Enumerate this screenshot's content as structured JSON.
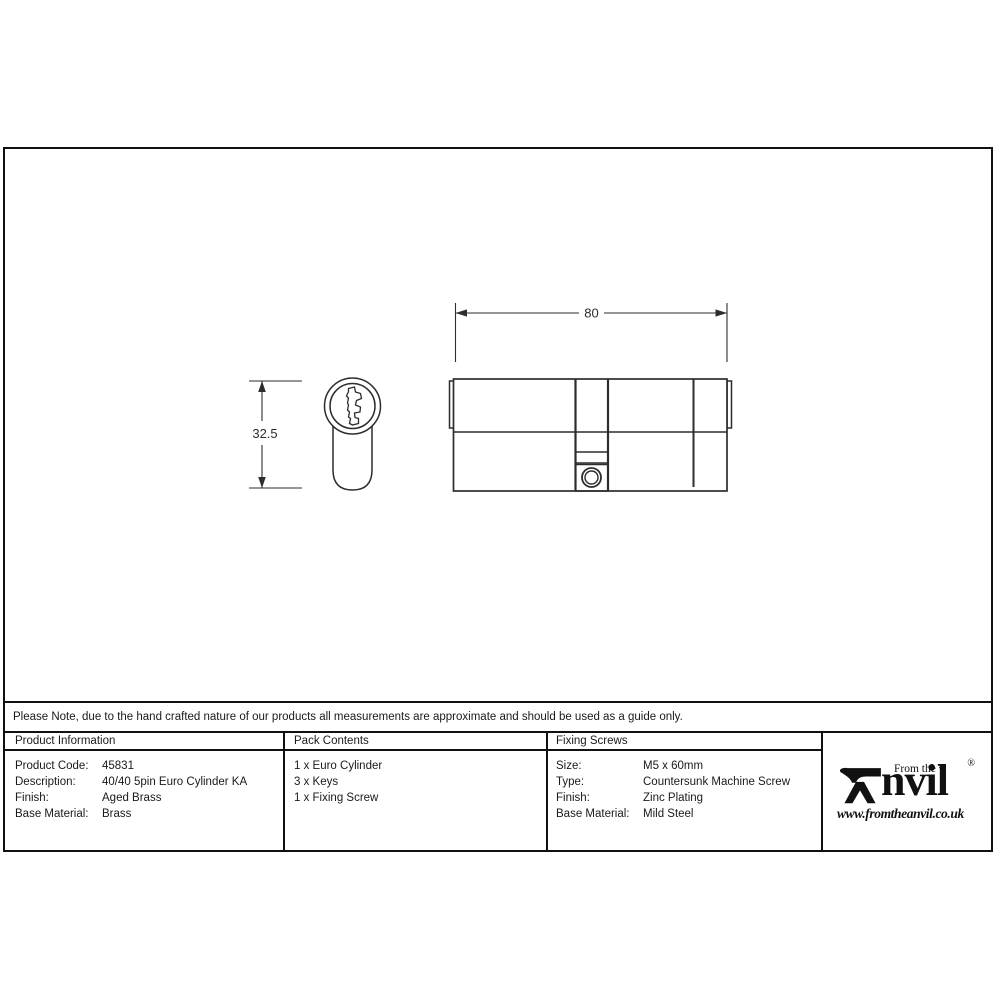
{
  "colors": {
    "background": "#ffffff",
    "border": "#111111",
    "drawing_line": "#2d2d2d",
    "text": "#1a1a1a"
  },
  "drawing": {
    "side_view_width_label": "80",
    "front_view_height_label": "32.5"
  },
  "note": {
    "text": "Please Note, due to the hand crafted nature of our products all measurements are approximate and should be used as a guide only."
  },
  "table": {
    "product_information": {
      "header": "Product Information",
      "rows": [
        {
          "label": "Product Code:",
          "value": "45831"
        },
        {
          "label": "Description:",
          "value": "40/40 5pin Euro Cylinder KA"
        },
        {
          "label": "Finish:",
          "value": "Aged Brass"
        },
        {
          "label": "Base Material:",
          "value": "Brass"
        }
      ]
    },
    "pack_contents": {
      "header": "Pack Contents",
      "items": [
        {
          "text": "1 x Euro Cylinder"
        },
        {
          "text": "3 x Keys"
        },
        {
          "text": "1 x Fixing Screw"
        }
      ]
    },
    "fixing_screws": {
      "header": "Fixing Screws",
      "rows": [
        {
          "label": "Size:",
          "value": "M5 x 60mm"
        },
        {
          "label": "Type:",
          "value": "Countersunk Machine Screw"
        },
        {
          "label": "Finish:",
          "value": "Zinc Plating"
        },
        {
          "label": "Base Material:",
          "value": "Mild Steel"
        }
      ]
    }
  },
  "logo": {
    "tagline": "From the",
    "diamond": "♦",
    "brand_rest": "nvil",
    "registered": "®",
    "website": "www.fromtheanvil.co.uk"
  }
}
